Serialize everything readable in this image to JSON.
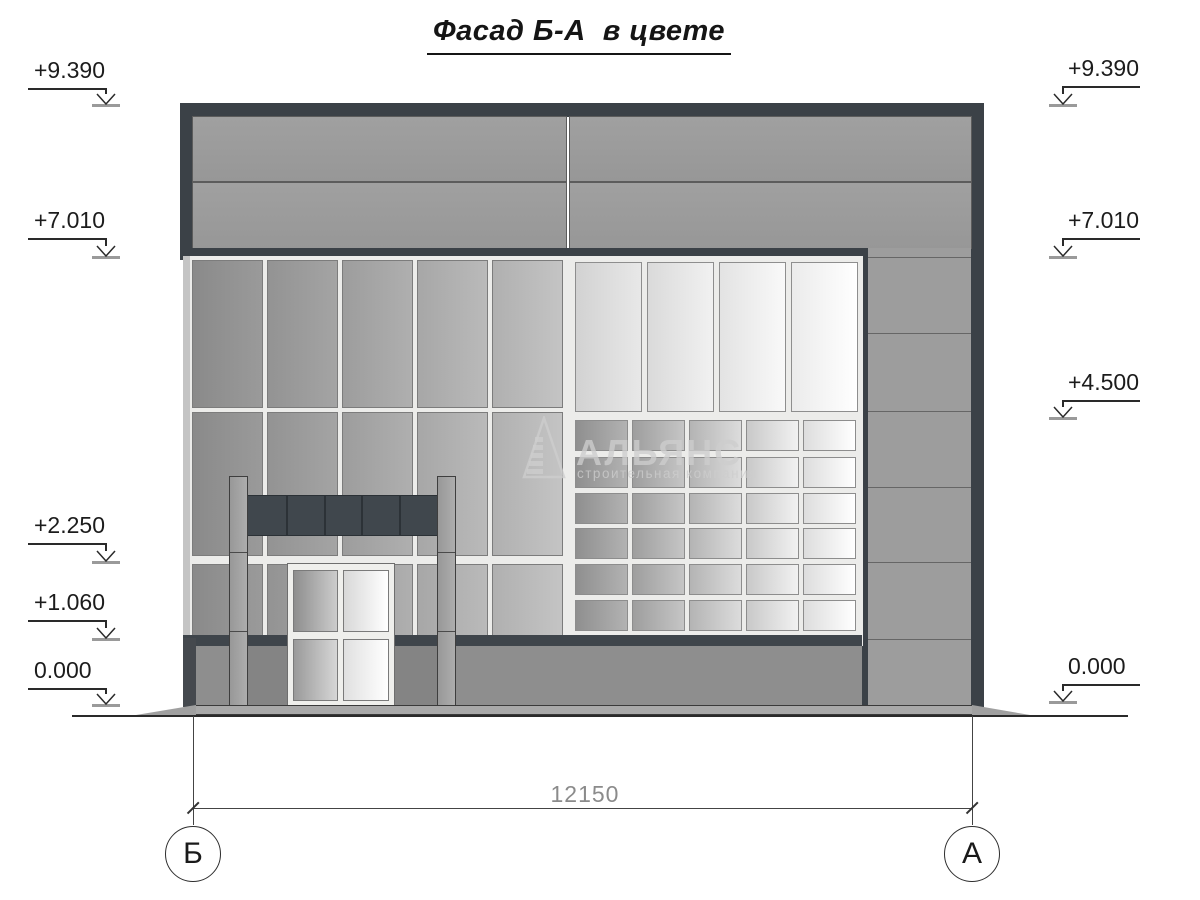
{
  "title": "Фасад Б-А  в цвете",
  "watermark": {
    "name": "АЛЬЯНС",
    "subtitle": "строительная компания"
  },
  "elevation_marks": {
    "left": [
      {
        "label": "+9.390"
      },
      {
        "label": "+7.010"
      },
      {
        "label": "+2.250"
      },
      {
        "label": "+1.060"
      },
      {
        "label": "0.000"
      }
    ],
    "right": [
      {
        "label": "+9.390"
      },
      {
        "label": "+7.010"
      },
      {
        "label": "+4.500"
      },
      {
        "label": "0.000"
      }
    ]
  },
  "dimension": {
    "label": "12150"
  },
  "axes": {
    "left": "Б",
    "right": "А"
  },
  "colors": {
    "dark_frame": "#3b4147",
    "wall_gray": "#9b9b9b",
    "canopy": "#40474d",
    "plinth": "#3f454b",
    "glazing_light": "#f5f5f5",
    "annotation": "#1c1c1c",
    "dimension_text": "#8b8b8b"
  }
}
